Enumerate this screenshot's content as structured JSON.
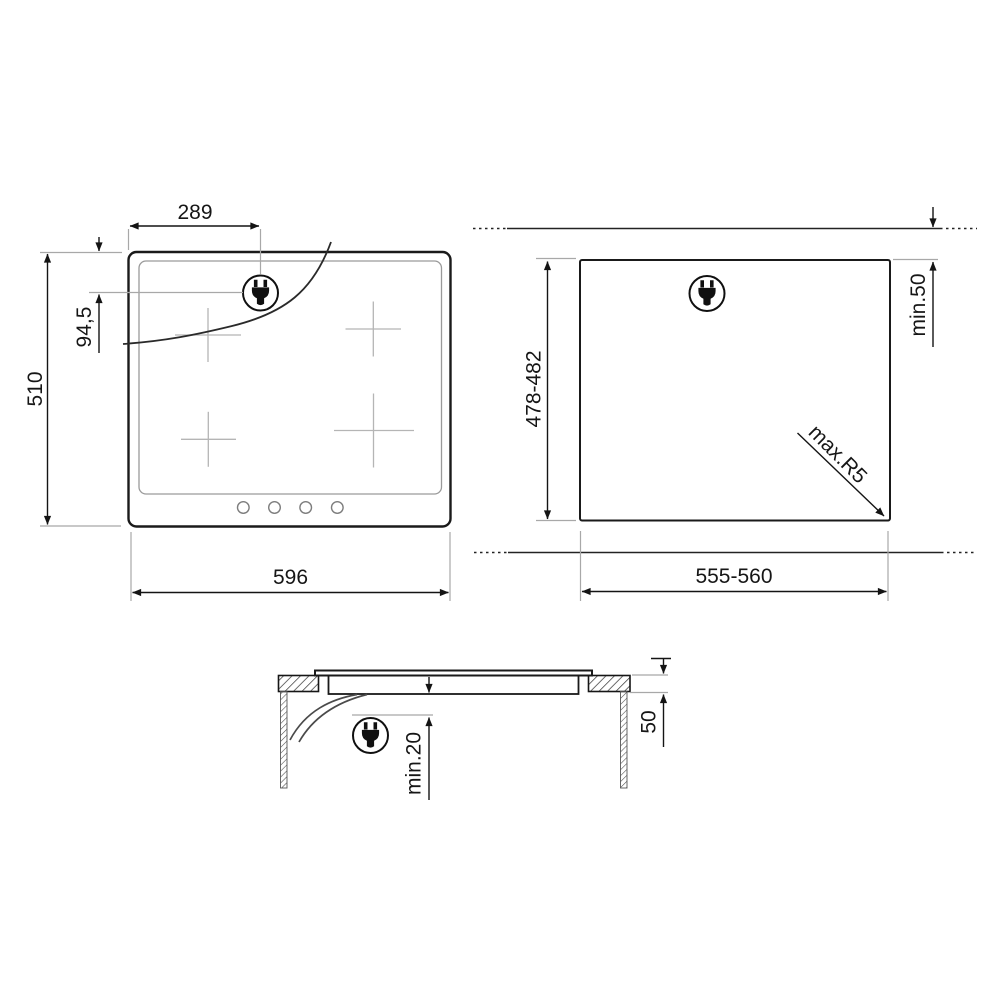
{
  "background": "#ffffff",
  "colors": {
    "line": "#1a1a1a",
    "dimension_line": "#141414",
    "auxiliary_line": "#a8a8a8",
    "burner_mark": "#b5b5b5",
    "background": "#ffffff"
  },
  "icons": {
    "power_plug": "power-plug-icon"
  },
  "views": {
    "hob_top_view": {
      "dimensions": {
        "plug_horizontal_offset": "289",
        "plug_vertical_offset": "94,5",
        "hob_depth": "510",
        "hob_width": "596"
      }
    },
    "worktop_cutout_view": {
      "dimensions": {
        "cutout_depth": "478-482",
        "rear_clearance": "min.50",
        "corner_radius": "max.R5",
        "cutout_width": "555-560"
      }
    },
    "side_section_view": {
      "dimensions": {
        "clearance_below": "min.20",
        "worktop_thickness": "50"
      }
    }
  }
}
